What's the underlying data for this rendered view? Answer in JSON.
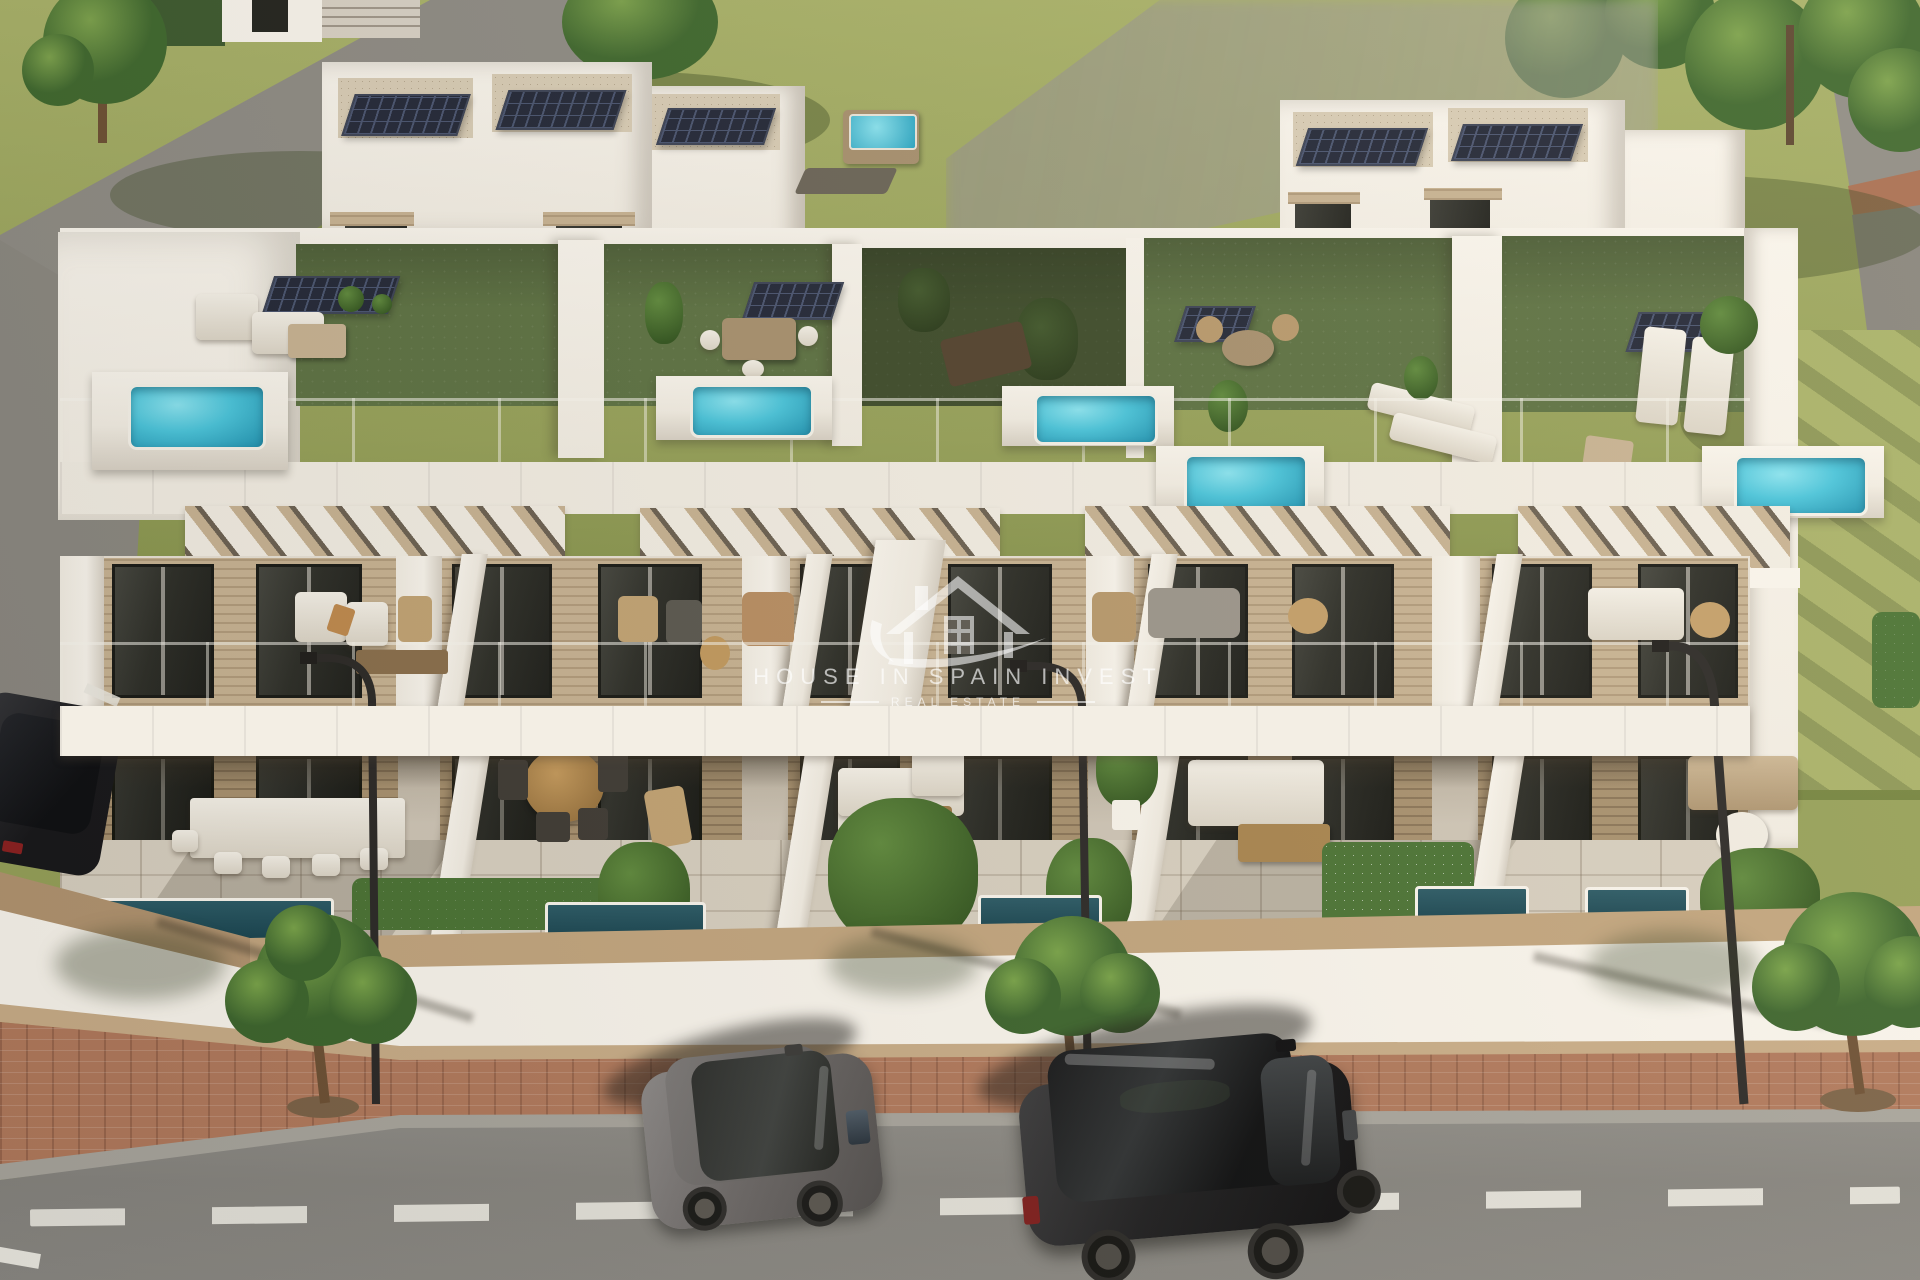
{
  "meta": {
    "type": "architectural-3d-render",
    "subject": "Aerial 3D render of a row of modern white townhouses with solar panels, rooftop garden terraces with plunge pools, glass balconies, ground-floor terraces and a street with parked cars",
    "width_px": 1920,
    "height_px": 1280
  },
  "watermark": {
    "logo": "house-with-swoosh-icon",
    "line1": "HOUSE IN SPAIN INVEST",
    "line2": "REAL ESTATE"
  },
  "palette": {
    "grass": "#96a159",
    "grass_light": "#a9b269",
    "grass_shadow": "#74843f",
    "path_gray": "#8f8c85",
    "mask_gray": "#9c9992",
    "white_bright": "#faf6ee",
    "white_sun": "#f3eee4",
    "white_shade": "#d9d2c6",
    "gravel": "#d9cdb6",
    "solar": "#232838",
    "solar_line": "#495470",
    "turf": "#5d7243",
    "turf_shadow": "#3c4a2e",
    "pool_water": "#49c5dc",
    "pool_water_deep": "#1f93b2",
    "pool_dark": "#16414d",
    "wood": "#c8b393",
    "wood_dark": "#a8916f",
    "wood_cap": "#c3a67f",
    "window_glass": "#2d2e28",
    "tile": "#d8d0c1",
    "hedge": "#4a7334",
    "plant_green": "#5f8a3d",
    "trunk_brown": "#6d5034",
    "brick": "#b1795c",
    "curb": "#a8a59d",
    "road": "#8a8883",
    "marking": "#eceae2",
    "car_gray": "#6e6a69",
    "car_black": "#1e1e20",
    "lamp_metal": "#2b2927",
    "watermark_white": "#ffffff"
  },
  "scene": {
    "background": {
      "lawn": "olive green grass with tree shadows",
      "trees_top_left": 2,
      "trees_top_right": 5,
      "paths": "gray concrete walkways",
      "masked_region": "neighbouring building blurred out, top centre-right",
      "background_house": "white house with entrance stairs, top-left"
    },
    "building": {
      "visible_units": 5,
      "levels": [
        "penthouse roof decks with solar panels",
        "rooftop artificial-turf terraces",
        "first-floor balconies with glass railings",
        "ground-floor tiled terraces"
      ],
      "penthouse_blocks": 3,
      "solar_panel_arrays_on_roofs": 6,
      "solar_panel_arrays_on_terraces": 4,
      "rooftop_plunge_pools": 5,
      "rooftop_hot_tub": 1,
      "wood_pergolas": 4,
      "facade": "white stucco with light wood cladding and dark glass sliding doors",
      "ground_floor_pools": 5,
      "perimeter_wall": "white wall with wooden cap"
    },
    "street": {
      "sidewalk": "white pavement with red clay-brick band",
      "street_trees": 3,
      "street_lamps": 3,
      "cars": [
        {
          "type": "compact hatchback",
          "color": "gray",
          "position": "parked centre-left"
        },
        {
          "type": "SUV",
          "color": "black",
          "position": "parked centre-right"
        },
        {
          "type": "sedan (partially visible)",
          "color": "black",
          "position": "far-left side street"
        }
      ],
      "road_marking": "white dashed centre line"
    }
  }
}
